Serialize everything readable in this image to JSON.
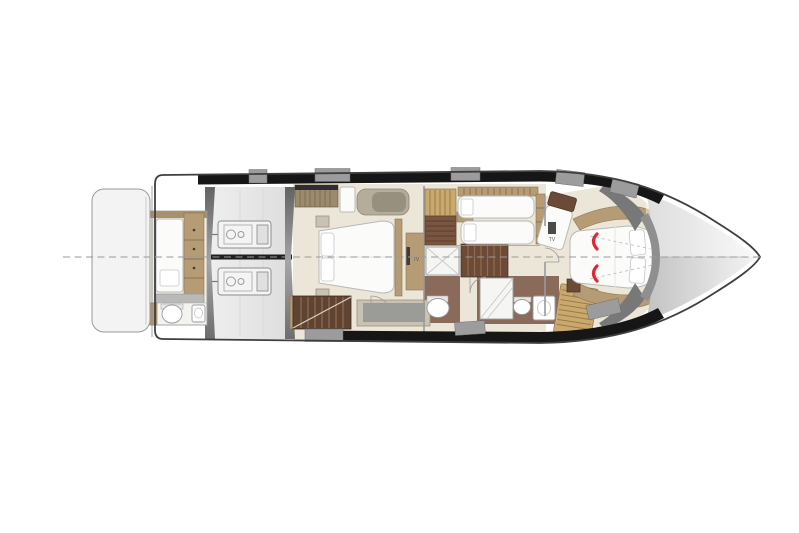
{
  "meta": {
    "subject": "motor yacht lower-deck floor plan",
    "view": "top-down, bow pointing right"
  },
  "labels": {
    "tv_master": "TV",
    "tv_vip": "TV"
  },
  "colors": {
    "hull-stroke": "#3f3f3f",
    "band-dark": "#161616",
    "band-gray": "#9c9c9c",
    "platform-fill": "#f3f3f3",
    "floor-cream": "#ebe6d8",
    "floor-brown": "#8a6b59",
    "wood-tan": "#b59c74",
    "wood-mid": "#caa96e",
    "wood-dark": "#6b4a38",
    "stairs-dark": "#5f4434",
    "furn-white": "#fbfbf9",
    "furn-stroke": "#b8b8b8",
    "wall-gray": "#8f8f8f",
    "line-gray": "#9a9a9a",
    "accent-red": "#e02835",
    "keel-dark": "#1e1e1e"
  }
}
